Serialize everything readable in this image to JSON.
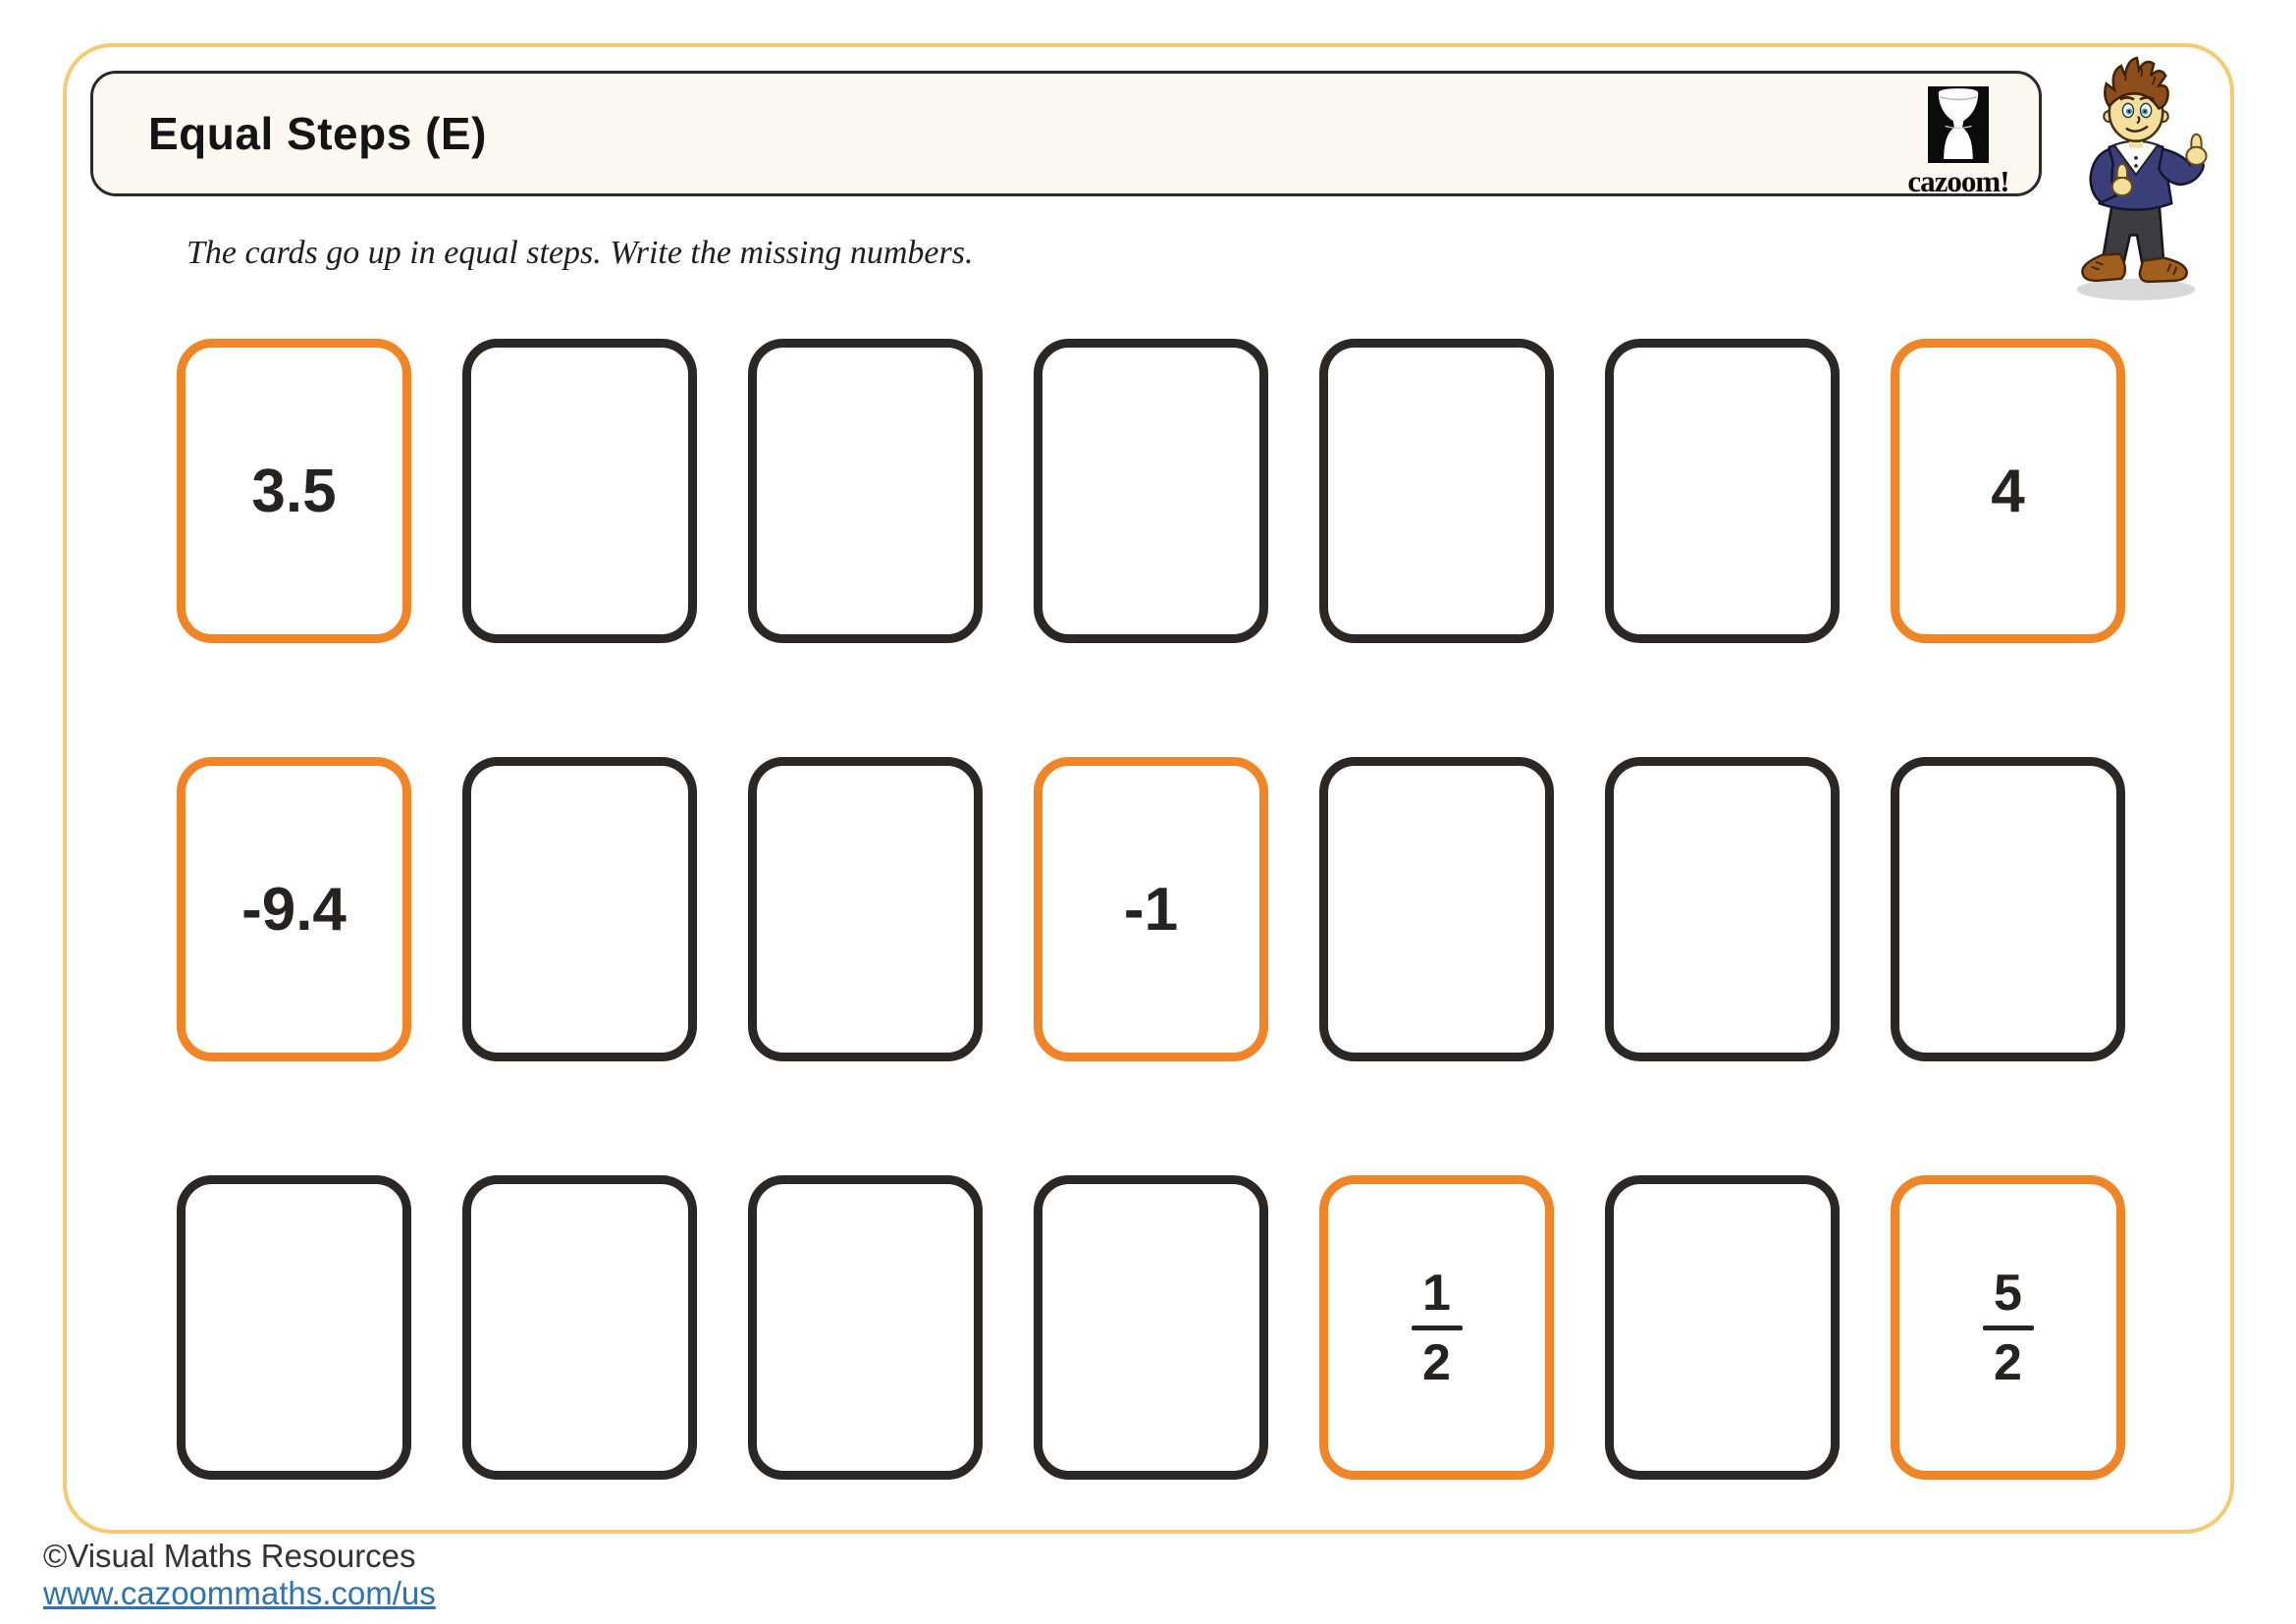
{
  "header": {
    "title": "Equal Steps (E)"
  },
  "logo": {
    "caption": "cazoom!"
  },
  "instruction": "The cards go up in equal steps. Write the missing numbers.",
  "colors": {
    "frame_yellow": "#F6CA70",
    "card_orange": "#F08527",
    "card_dark": "#2B2725",
    "title_box_bg": "#FAF8F1",
    "link_blue": "#2E72B0",
    "text_dark": "#262222"
  },
  "card_rows": [
    {
      "cards": [
        {
          "type": "number",
          "label": "3.5",
          "highlight": true
        },
        {
          "type": "empty",
          "label": "",
          "highlight": false
        },
        {
          "type": "empty",
          "label": "",
          "highlight": false
        },
        {
          "type": "empty",
          "label": "",
          "highlight": false
        },
        {
          "type": "empty",
          "label": "",
          "highlight": false
        },
        {
          "type": "empty",
          "label": "",
          "highlight": false
        },
        {
          "type": "number",
          "label": "4",
          "highlight": true
        }
      ]
    },
    {
      "cards": [
        {
          "type": "number",
          "label": "-9.4",
          "highlight": true
        },
        {
          "type": "empty",
          "label": "",
          "highlight": false
        },
        {
          "type": "empty",
          "label": "",
          "highlight": false
        },
        {
          "type": "number",
          "label": "-1",
          "highlight": true
        },
        {
          "type": "empty",
          "label": "",
          "highlight": false
        },
        {
          "type": "empty",
          "label": "",
          "highlight": false
        },
        {
          "type": "empty",
          "label": "",
          "highlight": false
        }
      ]
    },
    {
      "cards": [
        {
          "type": "empty",
          "label": "",
          "highlight": false
        },
        {
          "type": "empty",
          "label": "",
          "highlight": false
        },
        {
          "type": "empty",
          "label": "",
          "highlight": false
        },
        {
          "type": "empty",
          "label": "",
          "highlight": false
        },
        {
          "type": "fraction",
          "numerator": "1",
          "denominator": "2",
          "highlight": true
        },
        {
          "type": "empty",
          "label": "",
          "highlight": false
        },
        {
          "type": "fraction",
          "numerator": "5",
          "denominator": "2",
          "highlight": true
        }
      ]
    }
  ],
  "footer": {
    "copyright": "©Visual Maths Resources",
    "link": "www.cazoommaths.com/us"
  }
}
